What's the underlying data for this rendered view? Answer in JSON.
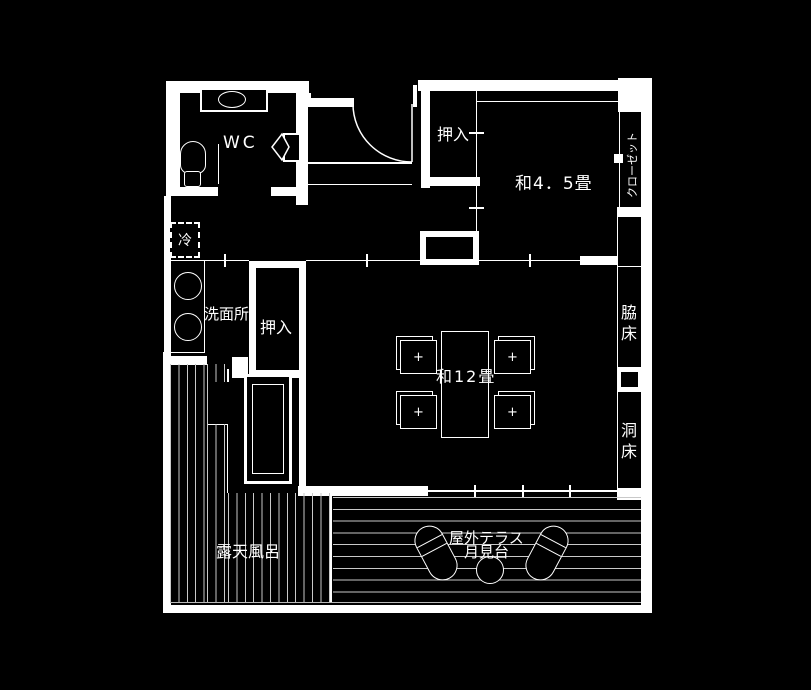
{
  "colors": {
    "background": "#000000",
    "wall": "#ffffff",
    "plank_stripe": "#c9c9c9",
    "text": "#ffffff"
  },
  "labels": {
    "wc": "WC",
    "oshiire_upper": "押入",
    "washitsu_45": "和4．5畳",
    "closet": "クローゼット",
    "refrigerator": "冷",
    "washroom": "洗面所",
    "oshiire_lower": "押入",
    "washitsu_12": "和12畳",
    "wakidoko": "脇床",
    "horadoko": "洞床",
    "rotenburo": "露天風呂",
    "terrace_name": "屋外テラス",
    "terrace_subname": "月見台"
  },
  "icons": {
    "toilet": "toilet-icon",
    "wash_basin": "wash-basin-icon",
    "bifold_door": "bifold-door-icon",
    "entry_door": "door-swing-icon",
    "fridge_box": "refrigerator-icon",
    "laundry_basins": "basin-circle-icon",
    "bathtub": "bathtub-icon",
    "dining_table": "dining-table-icon",
    "chair": "chair-icon",
    "lounger": "deck-lounger-icon",
    "round_table": "round-table-icon",
    "closet_knob": "door-knob-icon"
  }
}
